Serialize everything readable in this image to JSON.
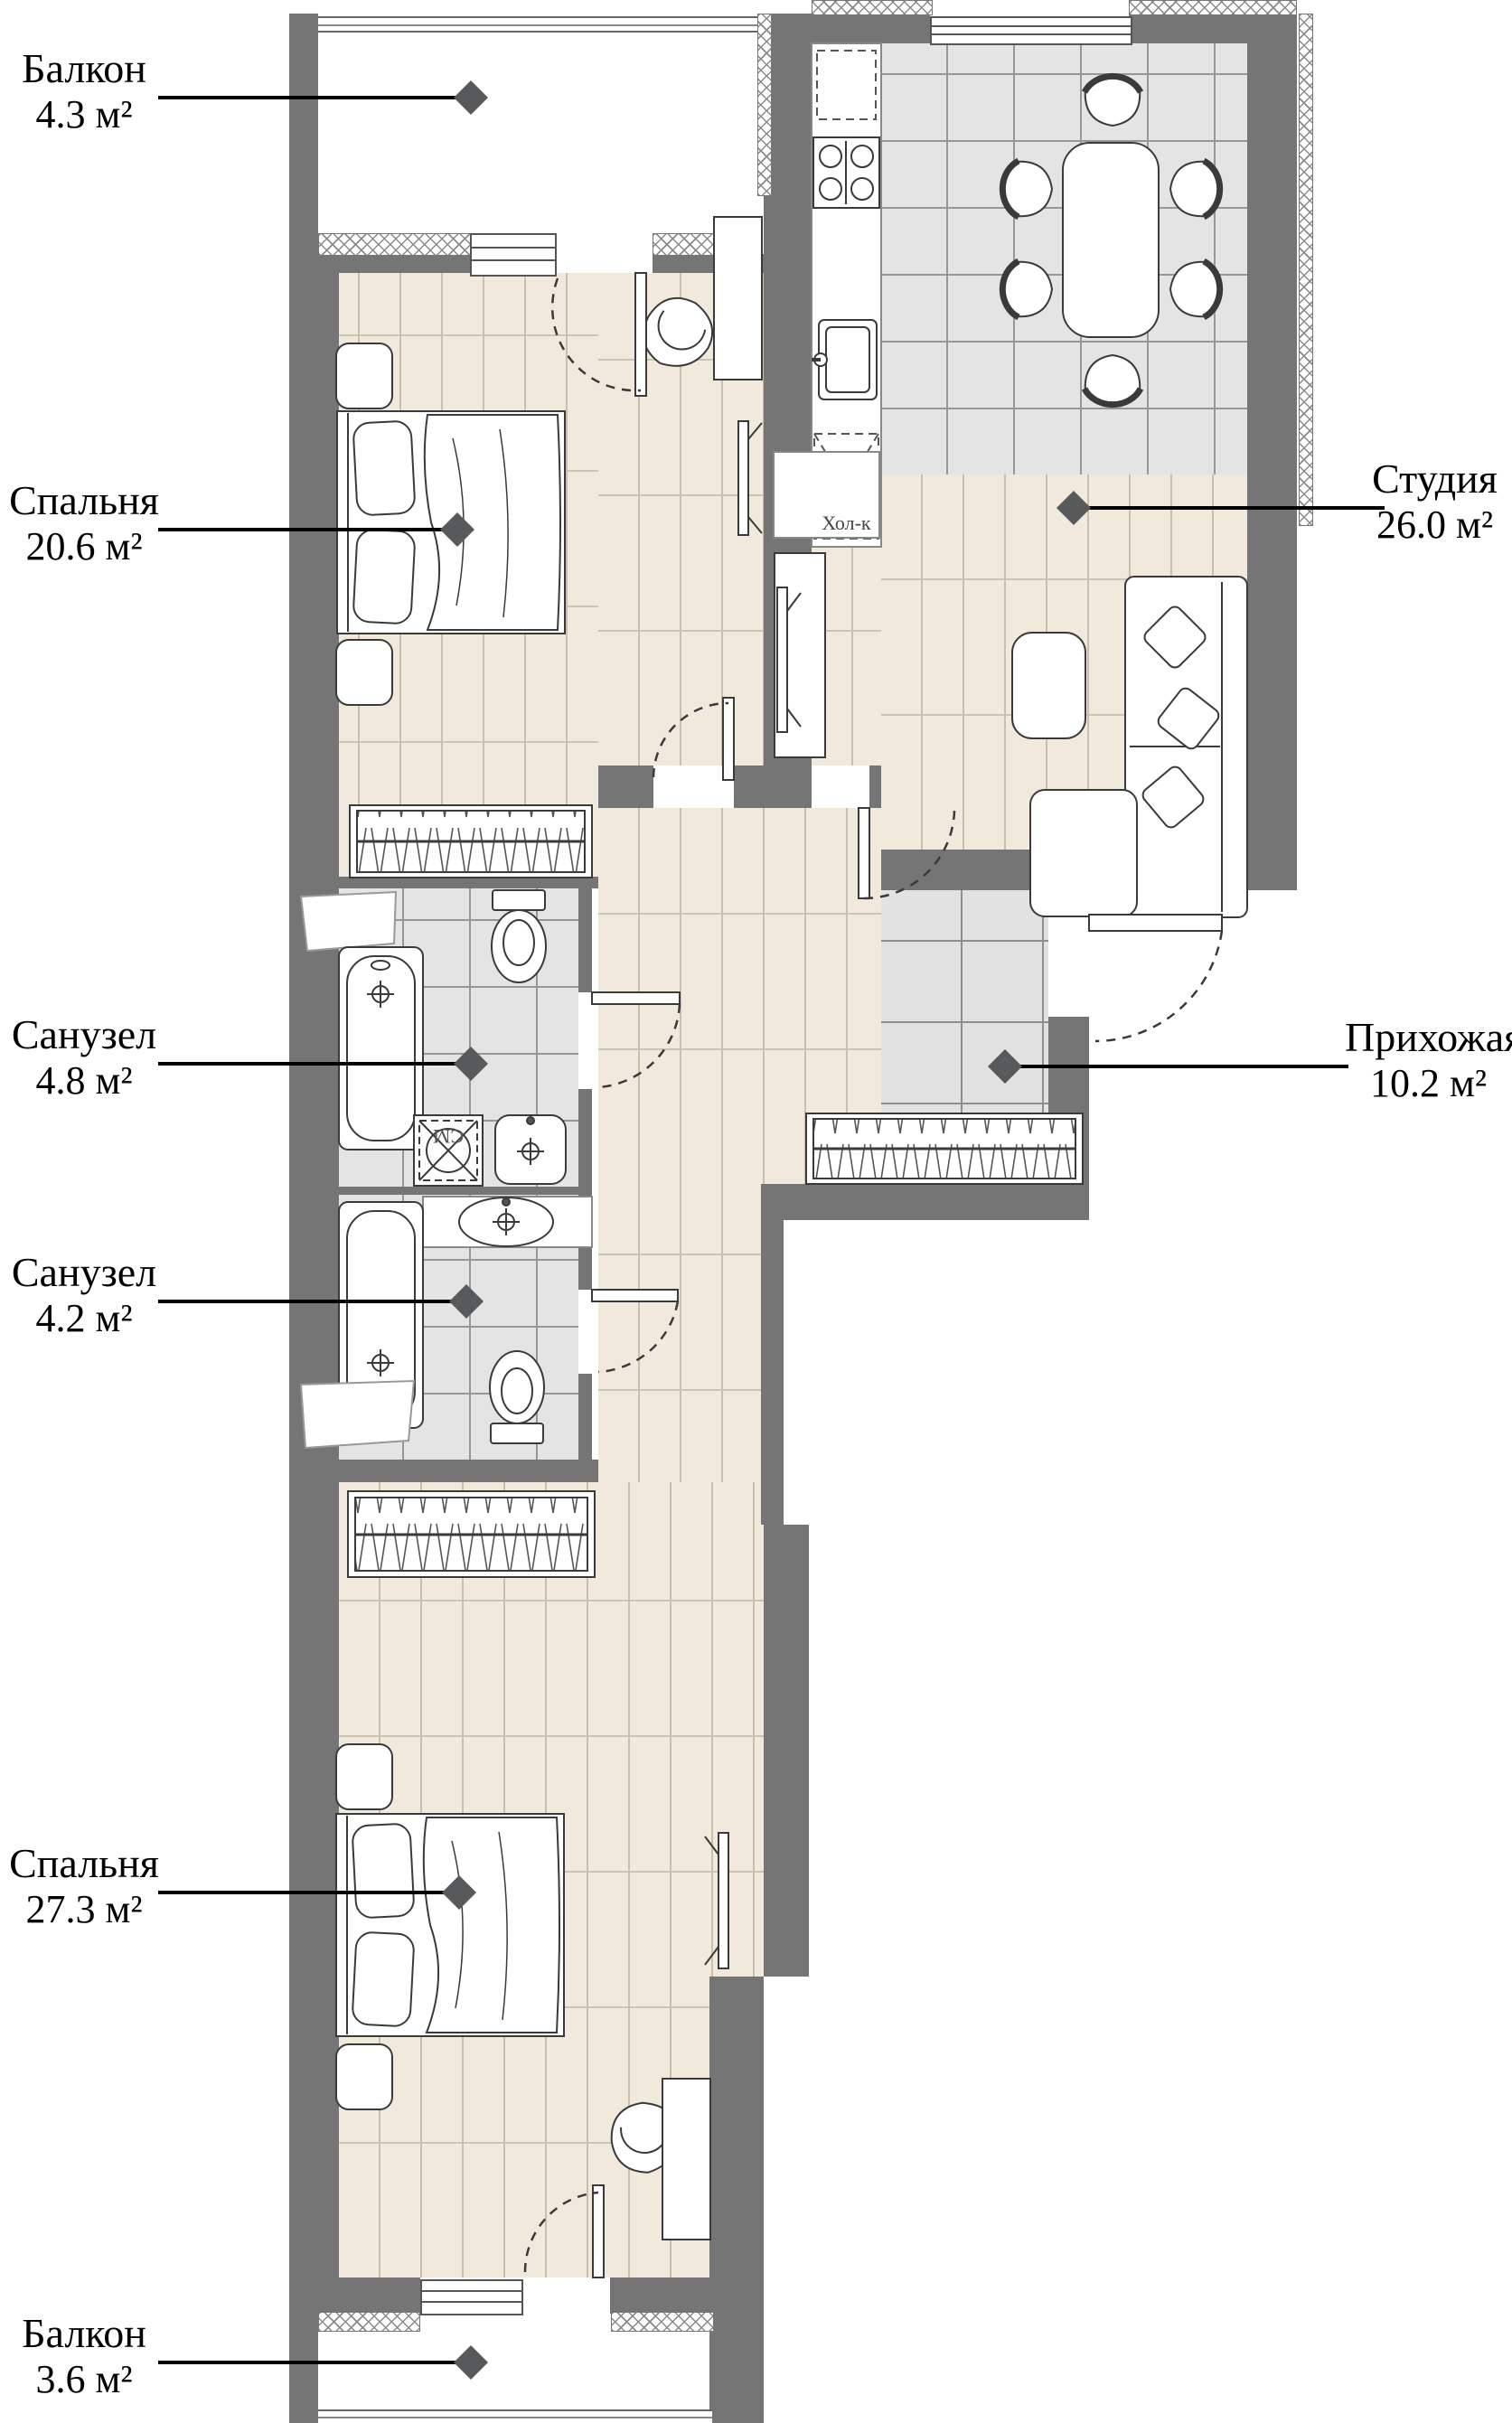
{
  "plan_type": "apartment-floor-plan",
  "rooms": [
    {
      "id": "balcony-top",
      "name": "Балкон",
      "area": "4.3 м²"
    },
    {
      "id": "bedroom-top",
      "name": "Спальня",
      "area": "20.6 м²"
    },
    {
      "id": "studio",
      "name": "Студия",
      "area": "26.0 м²"
    },
    {
      "id": "bathroom-1",
      "name": "Санузел",
      "area": "4.8 м²"
    },
    {
      "id": "hallway",
      "name": "Прихожая",
      "area": "10.2 м²"
    },
    {
      "id": "bathroom-2",
      "name": "Санузел",
      "area": "4.2 м²"
    },
    {
      "id": "bedroom-bottom",
      "name": "Спальня",
      "area": "27.3 м²"
    },
    {
      "id": "balcony-bottom",
      "name": "Балкон",
      "area": "3.6 м²"
    }
  ],
  "labels": {
    "fridge": "Хол-к",
    "washer": "СМ"
  },
  "colors": {
    "wall": "#757575",
    "wood_floor": "#f1e9dc",
    "tile_floor": "#e4e4e4",
    "marker": "#58595b",
    "line": "#000000"
  }
}
